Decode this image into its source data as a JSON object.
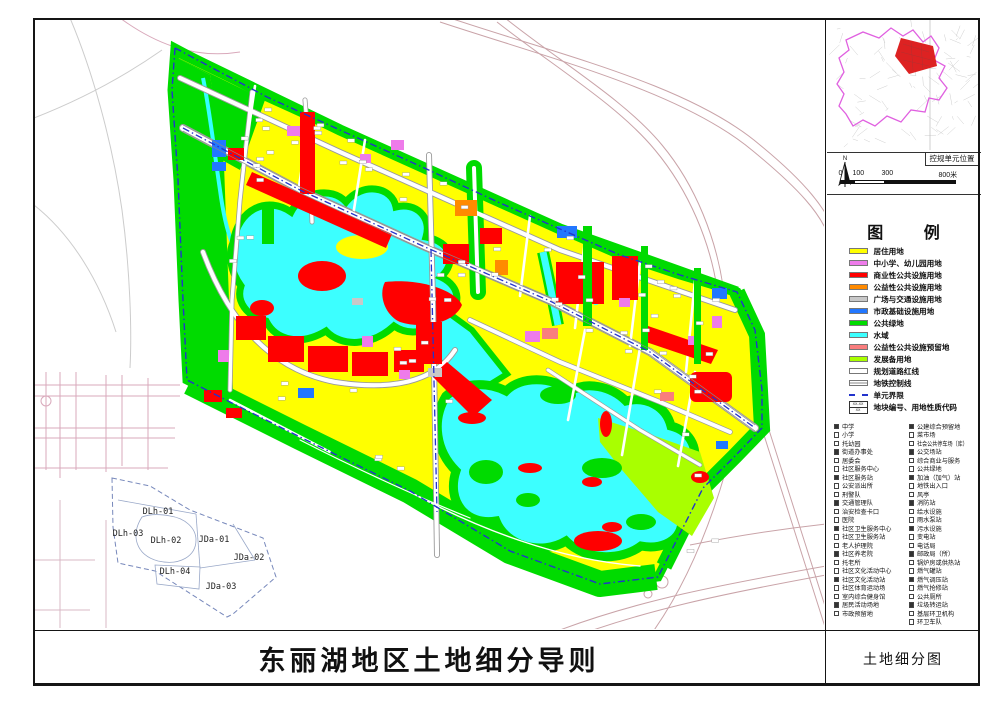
{
  "sheet": {
    "main_title": "东丽湖地区土地细分导则",
    "drawing_title": "土地细分图"
  },
  "inset": {
    "label": "控规单元位置",
    "north_label": "N",
    "scale_ticks": [
      "0",
      "100",
      "300",
      "800米"
    ],
    "boundary_color": "#e060e0",
    "unit_color": "#dd2222"
  },
  "legend": {
    "title": "图  例",
    "color_items": [
      {
        "label": "居住用地",
        "color": "#ffff00",
        "type": "fill"
      },
      {
        "label": "中小学、幼儿园用地",
        "color": "#ee7bea",
        "type": "fill"
      },
      {
        "label": "商业性公共设施用地",
        "color": "#ff0000",
        "type": "fill"
      },
      {
        "label": "公益性公共设施用地",
        "color": "#ff8a00",
        "type": "fill"
      },
      {
        "label": "广场与交通设施用地",
        "color": "#c8c8c8",
        "type": "fill"
      },
      {
        "label": "市政基础设施用地",
        "color": "#2277ff",
        "type": "fill"
      },
      {
        "label": "公共绿地",
        "color": "#00db00",
        "type": "fill"
      },
      {
        "label": "水域",
        "color": "#3cffff",
        "type": "fill"
      },
      {
        "label": "公益性公共设施预留地",
        "color": "#f97d7d",
        "type": "fill"
      },
      {
        "label": "发展备用地",
        "color": "#a9ff00",
        "type": "fill"
      },
      {
        "label": "规划道路红线",
        "color": "#ffffff",
        "type": "road"
      },
      {
        "label": "地铁控制线",
        "color": "#ffffff",
        "type": "metro"
      },
      {
        "label": "单元界限",
        "color": "#2233cc",
        "type": "dash"
      },
      {
        "label": "地块编号、用地性质代码",
        "type": "code",
        "line1": "XX-XX",
        "line2": "XX"
      }
    ],
    "symbol_items_left": [
      "中学",
      "小学",
      "托幼园",
      "街道办事处",
      "居委会",
      "社区服务中心",
      "社区服务站",
      "公安派出所",
      "刑警队",
      "交通管理队",
      "治安检查卡口",
      "医院",
      "社区卫生服务中心",
      "社区卫生服务站",
      "老人护理院",
      "社区养老院",
      "托老所",
      "社区文化活动中心",
      "社区文化活动站",
      "社区体育运动场",
      "室内综合健身馆",
      "居民活动场地",
      "市政预留地"
    ],
    "symbol_items_right": [
      "公建综合预留地",
      "菜市场",
      "社会公共停车场（库）",
      "公交场站",
      "综合商业与服务",
      "公共绿地",
      "加油（加气）站",
      "地铁出入口",
      "风亭",
      "消防站",
      "给水设施",
      "雨水泵站",
      "污水设施",
      "变电站",
      "电话局",
      "邮政局（所）",
      "锅炉房或供热站",
      "燃气罐站",
      "燃气调压站",
      "燃气抢修站",
      "公共厕所",
      "垃圾转运站",
      "基层环卫机构",
      "环卫车队"
    ]
  },
  "keyplan": {
    "units": [
      "DLh-01",
      "DLh-03",
      "DLh-02",
      "JDa-01",
      "JDa-02",
      "DLh-04",
      "JDa-03"
    ]
  }
}
